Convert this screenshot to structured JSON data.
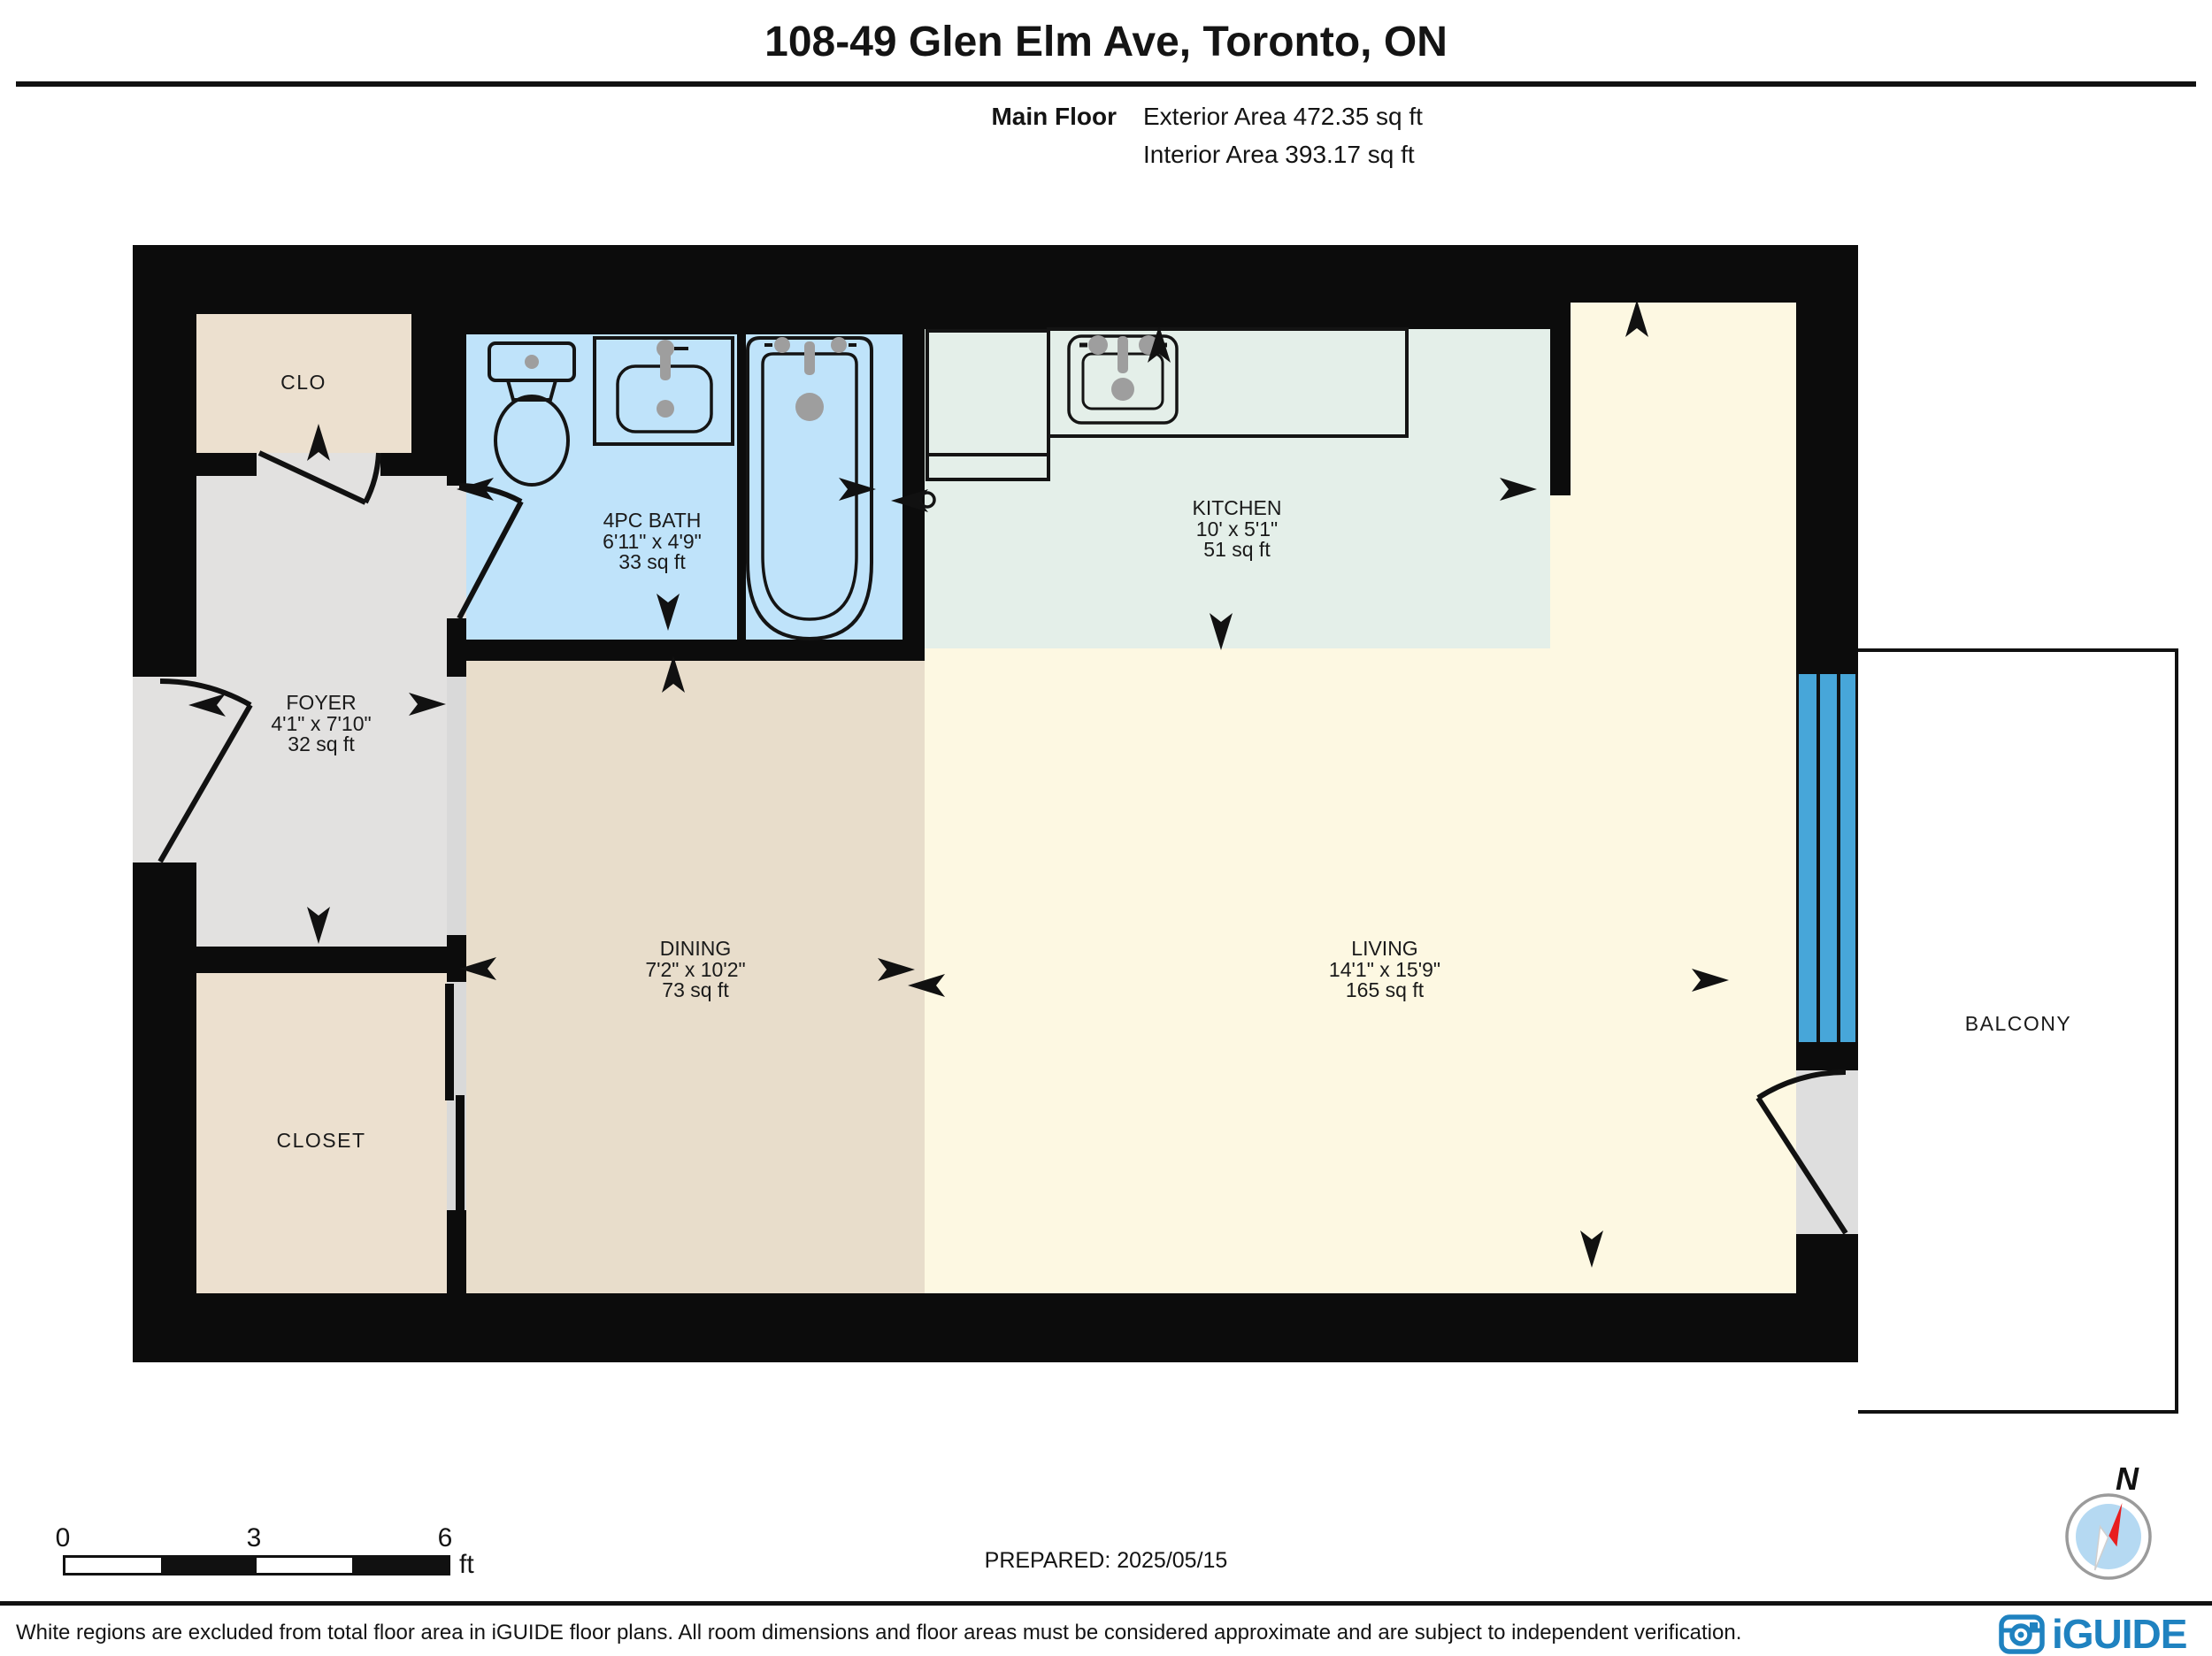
{
  "header": {
    "title": "108-49 Glen Elm Ave, Toronto, ON",
    "floor_label": "Main Floor",
    "exterior_area": "Exterior Area 472.35 sq ft",
    "interior_area": "Interior Area 393.17 sq ft"
  },
  "rooms": {
    "clo": {
      "name": "CLO"
    },
    "foyer": {
      "name": "FOYER",
      "dims": "4'1\" x 7'10\"",
      "area": "32 sq ft"
    },
    "bath": {
      "name": "4PC BATH",
      "dims": "6'11\" x 4'9\"",
      "area": "33 sq ft"
    },
    "kitchen": {
      "name": "KITCHEN",
      "dims": "10' x 5'1\"",
      "area": "51 sq ft"
    },
    "dining": {
      "name": "DINING",
      "dims": "7'2\" x 10'2\"",
      "area": "73 sq ft"
    },
    "living": {
      "name": "LIVING",
      "dims": "14'1\" x 15'9\"",
      "area": "165 sq ft"
    },
    "closet": {
      "name": "CLOSET"
    },
    "balcony": {
      "name": "BALCONY"
    }
  },
  "scale_bar": {
    "start": "0",
    "mid": "3",
    "end": "6",
    "unit": "ft"
  },
  "prepared_label": "PREPARED: 2025/05/15",
  "compass": {
    "north_label": "N"
  },
  "footer": {
    "disclaimer": "White regions are excluded from total floor area in iGUIDE floor plans. All room dimensions and floor areas must be considered approximate and are subject to independent verification.",
    "brand": "iGUIDE"
  },
  "colors": {
    "wall": "#0c0c0c",
    "bath_floor": "#bfe3fa",
    "kitchen_floor": "#e4efe9",
    "living_floor": "#fdf8e2",
    "dining_floor": "#e8ddcb",
    "closet_floor": "#ece0cf",
    "foyer_floor": "#e2e1e0",
    "window_glass": "#47a6d9",
    "brand_blue": "#1f82c0",
    "compass_red": "#e81e1e"
  }
}
